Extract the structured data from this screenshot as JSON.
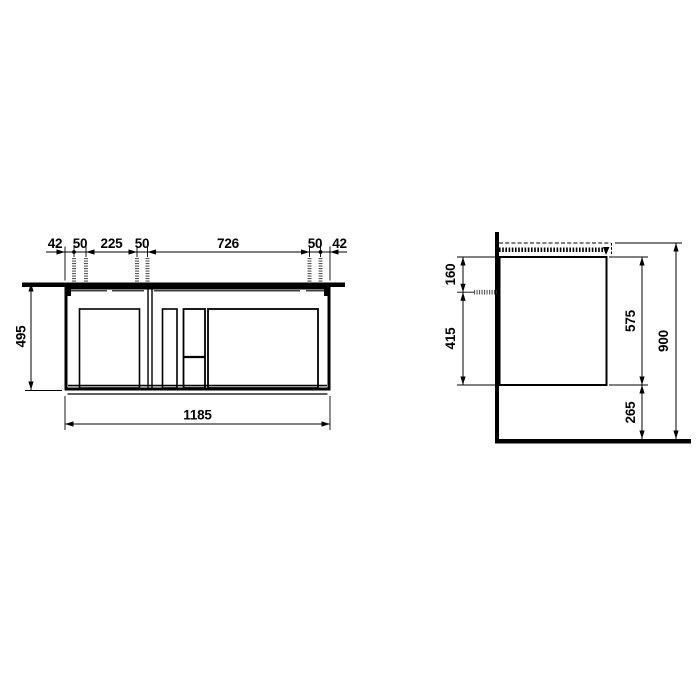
{
  "page": {
    "background": "#ffffff",
    "line_color": "#000000",
    "screw_color": "#555555"
  },
  "drawing": {
    "kind": "technical-dimension-drawing",
    "subject": "wall-mounted vanity unit, front and side elevation",
    "units": "mm",
    "front_view": {
      "top_dimension_chain": [
        "42",
        "50",
        "225",
        "50",
        "726",
        "50",
        "42"
      ],
      "height_label": "495",
      "width_label": "1185"
    },
    "side_view": {
      "top_to_fixing_label": "160",
      "fixing_to_bottom_label": "415",
      "body_height_label": "575",
      "floor_clearance_label": "265",
      "overall_height_label": "900"
    }
  }
}
